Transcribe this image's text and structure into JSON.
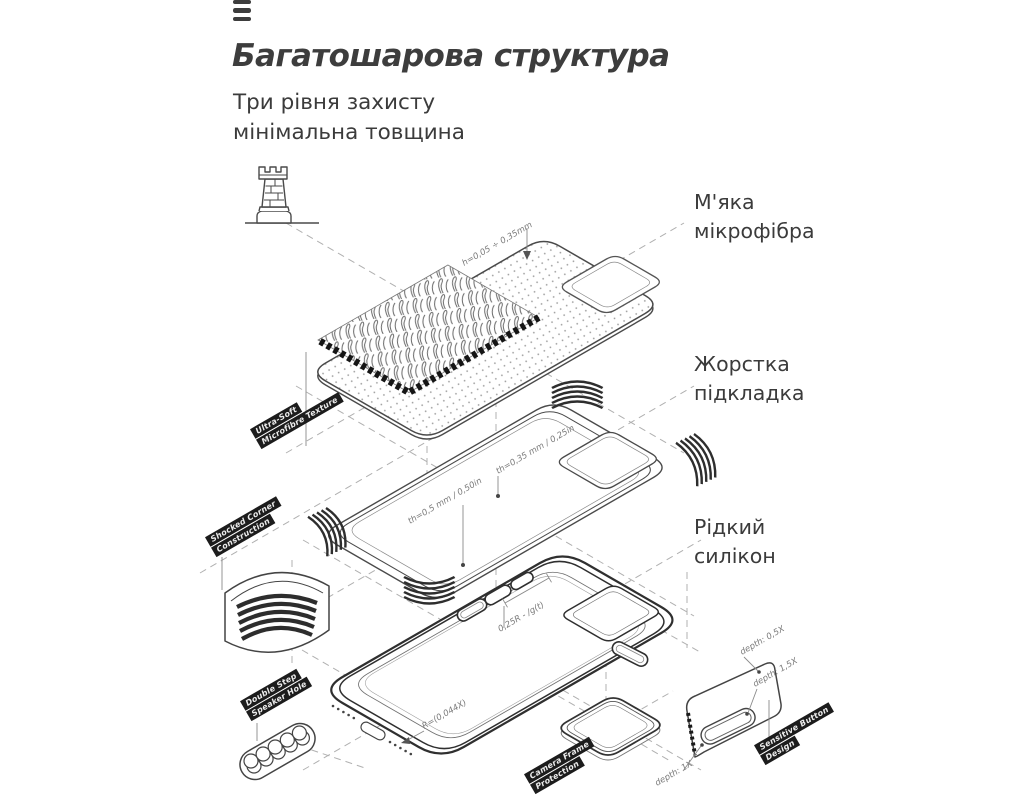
{
  "header": {
    "title": "Багатошарова структура",
    "subtitle1": "Три рівня захисту",
    "subtitle2": "мінімальна товщина"
  },
  "layer_labels": {
    "microfiber": "М'яка мікрофібра",
    "hard_lining": "Жорстка підкладка",
    "liquid_silicone": "Рідкий силікон"
  },
  "feature_tags": {
    "microfibre_texture": {
      "line1": "Ultra-Soft",
      "line2": "Microfibre Texture"
    },
    "corner_construction": {
      "line1": "Shocked Corner",
      "line2": "Construction"
    },
    "speaker_hole": {
      "line1": "Double Step",
      "line2": "Speaker Hole"
    },
    "camera_frame": {
      "line1": "Camera Frame",
      "line2": "Protection"
    },
    "sensitive_button": {
      "line1": "Sensitive Button",
      "line2": "Design"
    }
  },
  "dimensions": {
    "microfiber_height": "h=0,05 ÷ 0,35mm",
    "lining_thickness_camera": "th=0,35 mm / 0,25in",
    "lining_thickness_main": "th=0,5 mm / 0,50in",
    "case_edge_radius": "0,25R - /g(t)",
    "case_floor_radius": "R=(0,044X)",
    "button_depth_outer": "depth: 0,5X",
    "button_depth_inner": "depth: 1,5X",
    "button_depth_side": "depth: 1X"
  },
  "icons": {
    "menu": "hamburger-icon",
    "protection": "castle-tower-icon"
  },
  "colors": {
    "text": "#3b3b3b",
    "tag_bg": "#1c1c1c",
    "line": "#4a4a4a"
  }
}
